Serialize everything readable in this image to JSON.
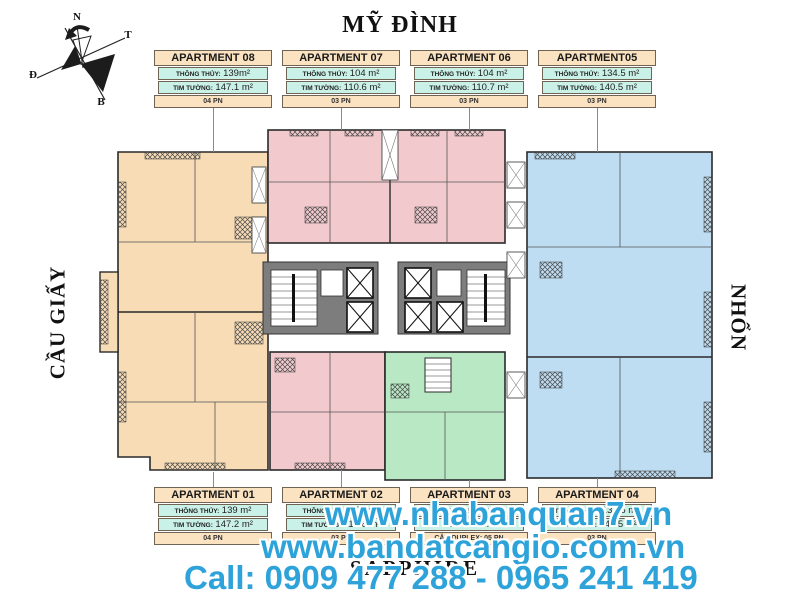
{
  "title": "MỸ ĐÌNH",
  "side_labels": {
    "left": "CẦU GIẤY",
    "right": "NHỔN"
  },
  "building_name": "SAPPHIRE",
  "compass": {
    "top": "N",
    "right": "T",
    "left": "Đ",
    "bottom": "B"
  },
  "cards_top": [
    {
      "name": "APARTMENT 08",
      "row1_label": "THÔNG THỦY:",
      "row1_value": "139m²",
      "row2_label": "TIM TƯỜNG:",
      "row2_value": "147.1 m²",
      "footer": "04 PN"
    },
    {
      "name": "APARTMENT 07",
      "row1_label": "THÔNG THỦY:",
      "row1_value": "104 m²",
      "row2_label": "TIM TƯỜNG:",
      "row2_value": "110.6 m²",
      "footer": "03 PN"
    },
    {
      "name": "APARTMENT 06",
      "row1_label": "THÔNG THỦY:",
      "row1_value": "104 m²",
      "row2_label": "TIM TƯỜNG:",
      "row2_value": "110.7 m²",
      "footer": "03 PN"
    },
    {
      "name": "APARTMENT05",
      "row1_label": "THÔNG THỦY:",
      "row1_value": "134.5 m²",
      "row2_label": "TIM TƯỜNG:",
      "row2_value": "140.5 m²",
      "footer": "03 PN"
    }
  ],
  "cards_bottom": [
    {
      "name": "APARTMENT 01",
      "row1_label": "THÔNG THỦY:",
      "row1_value": "139 m²",
      "row2_label": "TIM TƯỜNG:",
      "row2_value": "147.2 m²",
      "footer": "04 PN"
    },
    {
      "name": "APARTMENT 02",
      "row1_label": "THÔNG THỦY:",
      "row1_value": "104 m²",
      "row2_label": "TIM TƯỜNG:",
      "row2_value": "110.6 m²",
      "footer": "03 PN"
    },
    {
      "name": "APARTMENT 03",
      "row1_label": "THÔNG THỦY:",
      "row1_value": "",
      "row2_label": "TIM TƯỜNG:",
      "row2_value": "",
      "footer": "CĂN DUPLEX: 05 PN"
    },
    {
      "name": "APARTMENT 04",
      "row1_label": "THÔNG THỦY:",
      "row1_value": "134.5 m²",
      "row2_label": "TIM TƯỜNG:",
      "row2_value": "140.5 m²",
      "footer": "03 PN"
    }
  ],
  "watermark": {
    "line1": "www.nhabanquan7.vn",
    "line2": "www.bandatcangio.com.vn",
    "line3": "Call: 0909 477 288 - 0965 241 419",
    "color": "#2ea3d9"
  },
  "plan": {
    "colors": {
      "peach": "#f8dcb6",
      "pink": "#f2cace",
      "blue": "#bedcf2",
      "green": "#b8e8c4",
      "core": "#7d7d7d",
      "wall": "#2a2a2a"
    }
  }
}
